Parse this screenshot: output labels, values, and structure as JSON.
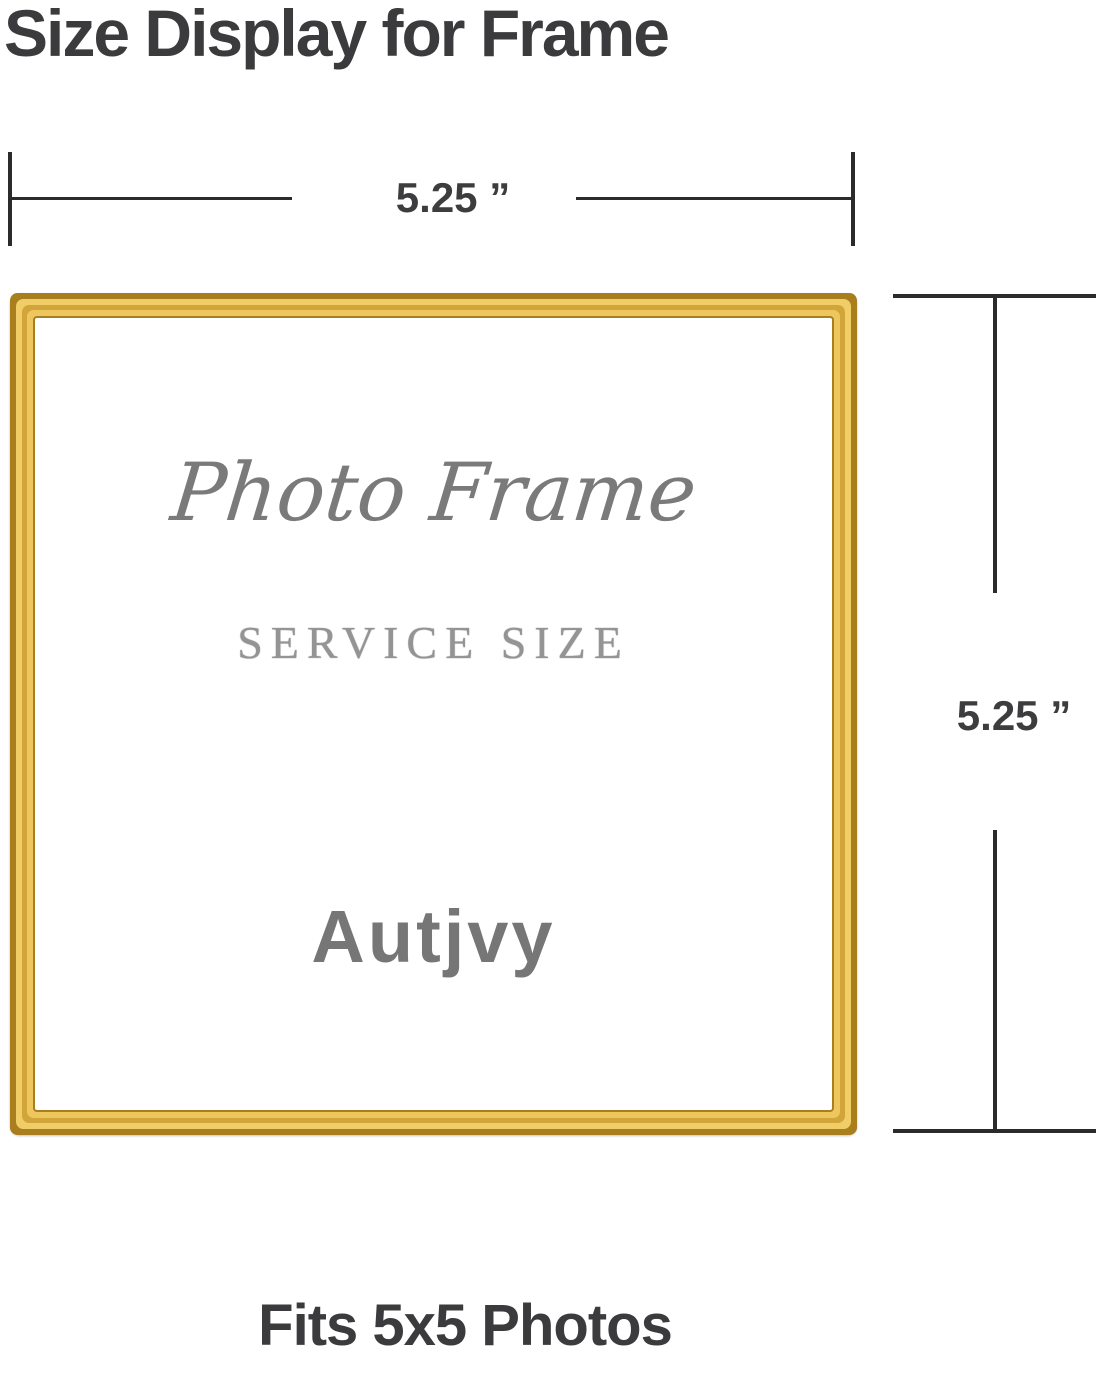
{
  "header": {
    "title": "Size Display for Frame"
  },
  "dimensions": {
    "width_label": "5.25 ”",
    "height_label": "5.25 ”"
  },
  "frame": {
    "script_text": "Photo Frame",
    "service_text": "SERVICE SIZE",
    "brand": "Autjvy"
  },
  "footer": {
    "caption": "Fits 5x5 Photos"
  },
  "colors": {
    "gold_frame": "#D2A53A",
    "gold_highlight": "#F0CD66",
    "gold_shadow": "#A97E1F",
    "heading_text": "#3B3B3D",
    "dimension_line": "#2B2B2B",
    "frame_text_gray": "#7A7A7A"
  }
}
